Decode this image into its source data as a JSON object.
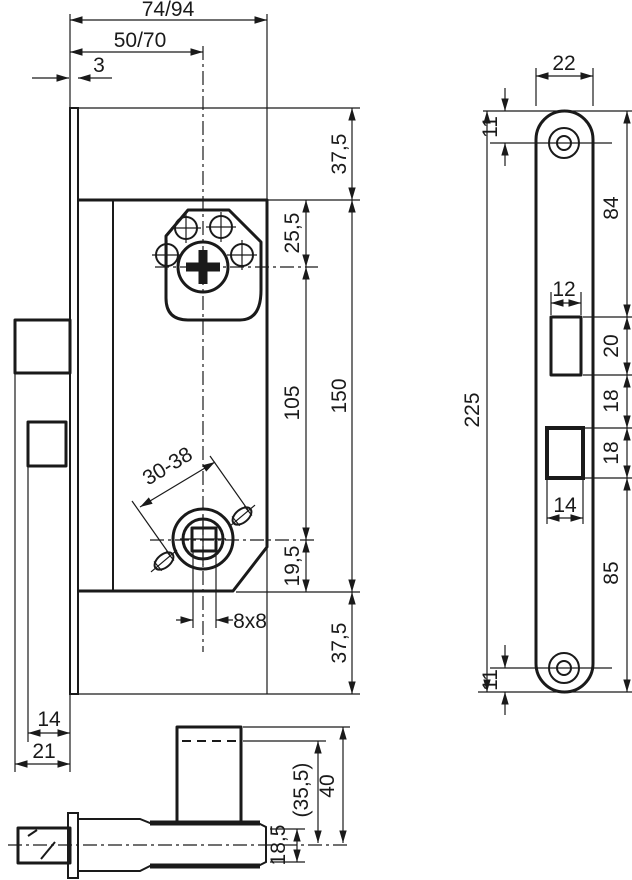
{
  "colors": {
    "line": "#1a1a1a",
    "background": "#ffffff"
  },
  "dimensions": {
    "front": {
      "overall_depth": "74/94",
      "backset": "50/70",
      "faceplate_thickness": "3",
      "top_margin": "37,5",
      "cylinder_to_centre": "25,5",
      "centre_distance": "105",
      "case_height": "150",
      "follower_to_bottom": "19,5",
      "bottom_margin": "37,5",
      "follower_square": "8x8",
      "adjustable_range": "30-38",
      "deadbolt_throw": "14",
      "latch_throw": "21"
    },
    "faceplate": {
      "width": "22",
      "top_screw_offset": "11",
      "top_section": "84",
      "latch_cutout_width": "12",
      "latch_cutout_height": "20",
      "cutout_gap": "18",
      "deadbolt_cutout_height": "18",
      "deadbolt_cutout_width": "14",
      "bottom_section": "85",
      "bottom_screw_offset": "11",
      "total_height": "225"
    },
    "bottom": {
      "hub_height_ref": "(35,5)",
      "hub_height": "40",
      "case_thickness": "18,5"
    }
  }
}
